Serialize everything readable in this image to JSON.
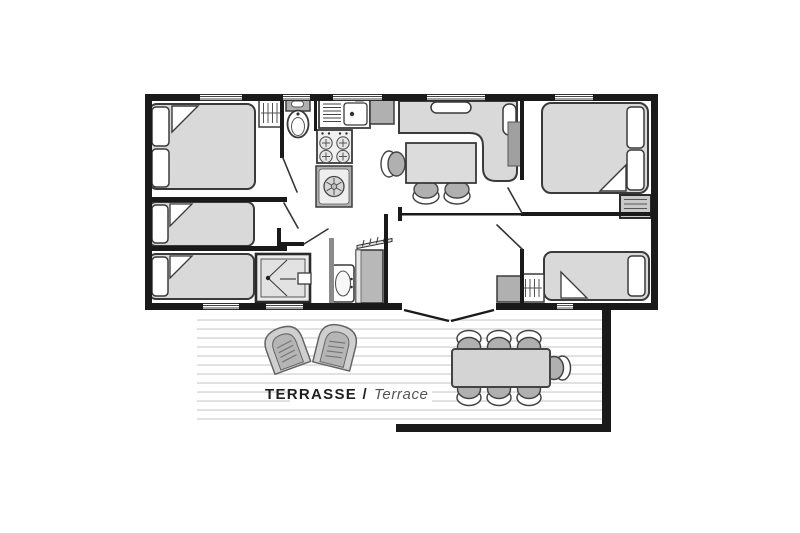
{
  "terrace": {
    "label_primary": "TERRASSE /",
    "label_secondary": "Terrace"
  },
  "colors": {
    "wall": "#1a1a1a",
    "stroke": "#3a3a3a",
    "fill_light": "#d9d9d9",
    "fill_mid": "#b0b0b0",
    "fill_dark": "#8a8a8a",
    "deck_line": "#dcdcdc",
    "label_primary_color": "#1f1f1f",
    "label_secondary_color": "#555555"
  },
  "rooms": {
    "bedroom_master": [
      "double-bed",
      "wardrobe-hangers"
    ],
    "bedroom_single_1": [
      "single-bed"
    ],
    "bedroom_single_2": [
      "single-bed"
    ],
    "wc": [
      "toilet"
    ],
    "kitchen": [
      "sink-unit",
      "fridge",
      "stove-4-burners",
      "washing-machine"
    ],
    "living_room": [
      "corner-sofa",
      "dining-table",
      "dining-chairs-3"
    ],
    "bedroom_right": [
      "double-bed",
      "shelf-unit"
    ],
    "bedroom_right_bottom": [
      "single-bed",
      "wardrobe-hangers",
      "cabinet"
    ],
    "shower_room": [
      "shower"
    ],
    "bathroom": [
      "washbasin",
      "tall-cabinet",
      "shelf"
    ],
    "terrace": [
      "lounge-chair",
      "lounge-chair",
      "dining-table",
      "chairs-7"
    ]
  }
}
